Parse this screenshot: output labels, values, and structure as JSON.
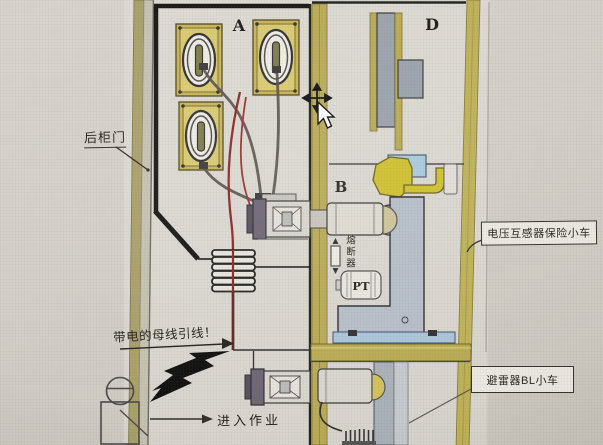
{
  "diagram": {
    "compartments": {
      "a": "A",
      "b": "B",
      "d": "D"
    },
    "annotations": {
      "rear_door": "后柜门",
      "live_busbar_lead": "带电的母线引线！",
      "enter_work": "进入作业",
      "fuse": "熔断器",
      "pt": "PT",
      "vt_fuse_trolley": "电压互感器保险小车",
      "arrester_trolley": "避雷器BL小车"
    },
    "colors": {
      "cabinet_wall_yellow": "#b9ab55",
      "busbar_highlight_yellow": "#cfc12f",
      "live_wire_red": "#8c2828",
      "trolley_gray_blue": "#b6bec9",
      "rail_light_blue": "#a9c6da",
      "panel_gray": "#9aa2ab",
      "outline_black": "#1c1c1c",
      "paper_background": "#e0ddd6"
    },
    "cursor": {
      "type": "move-with-pointer"
    }
  }
}
